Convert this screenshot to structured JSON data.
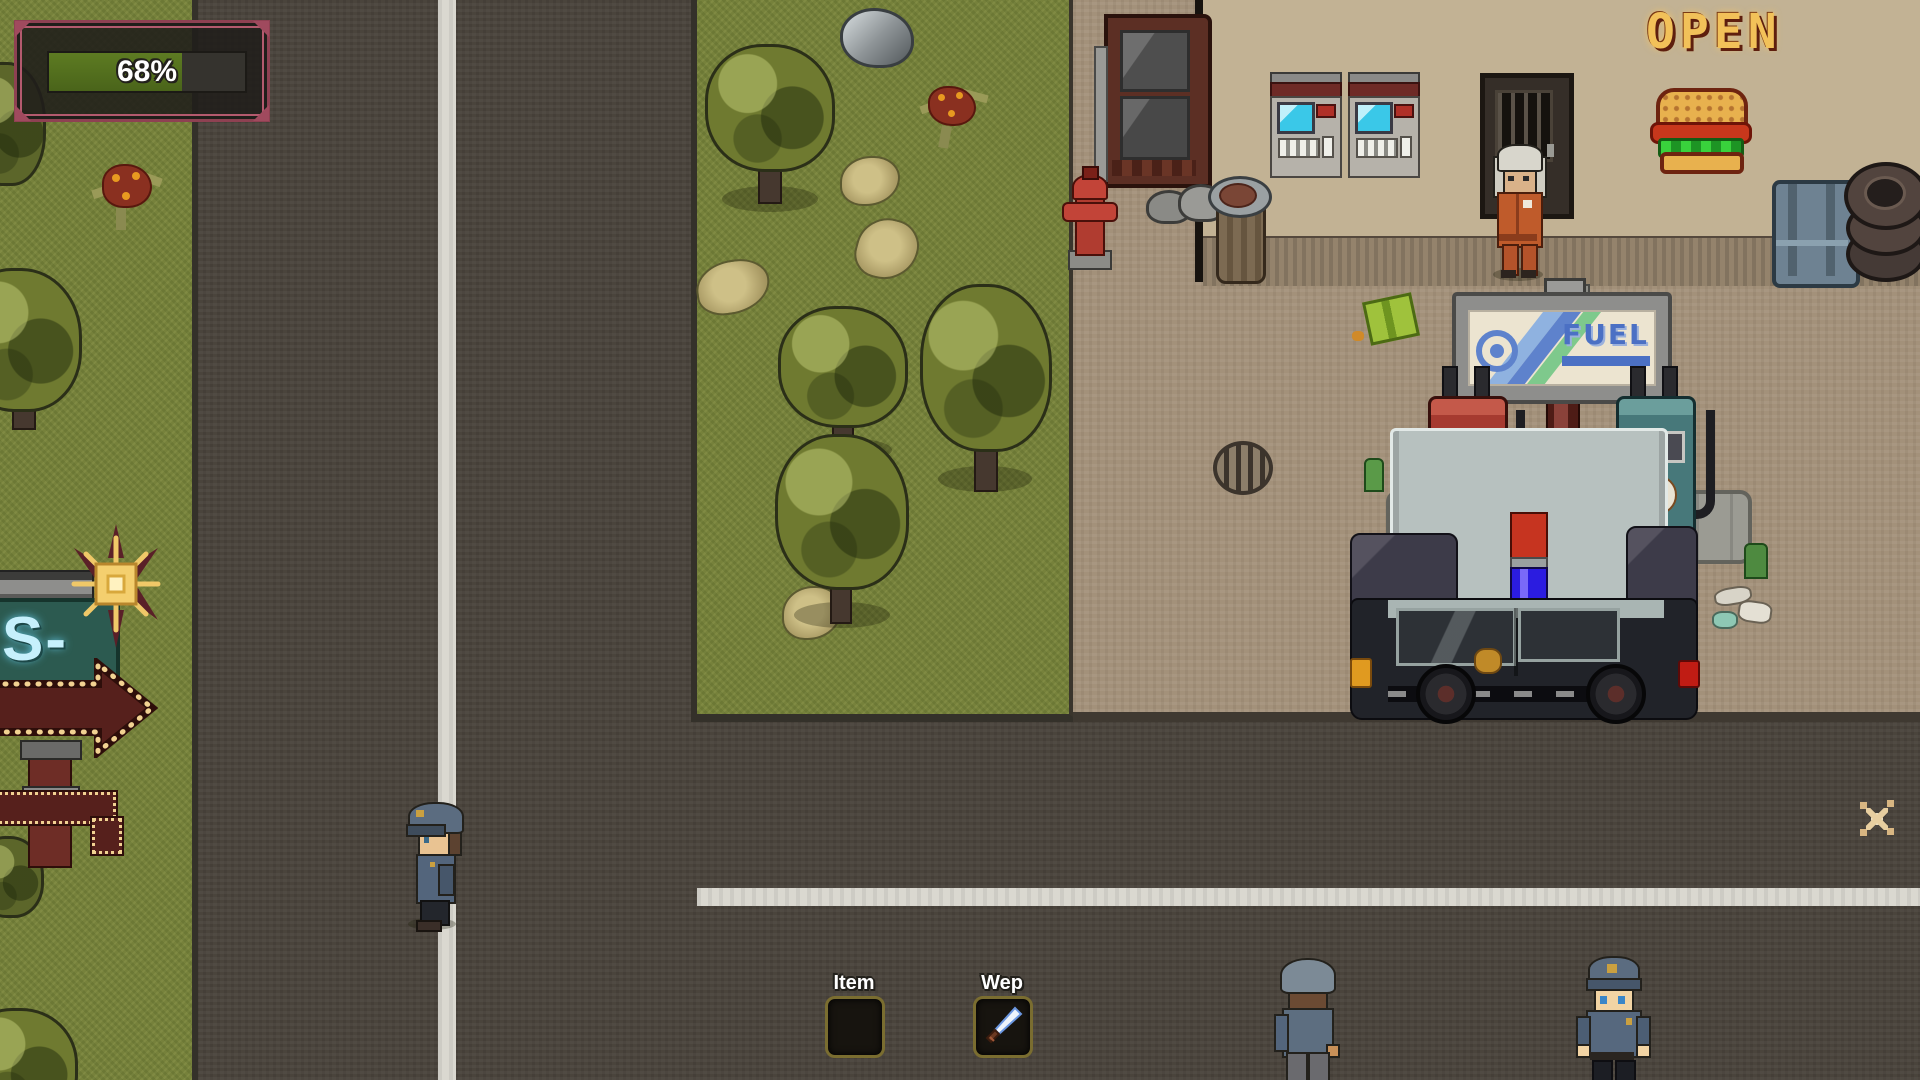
{
  "hud": {
    "health_label": "68%",
    "health_percent": 68
  },
  "hotbar": {
    "slots": [
      {
        "label": "Item",
        "contents": ""
      },
      {
        "label": "Wep",
        "contents": "knife-icon"
      }
    ]
  },
  "gas_station": {
    "open_sign": "OPEN",
    "fuel_sign": "FUEL",
    "burger_sign": "burger-neon-icon"
  },
  "roadside_sign": {
    "text": "S-",
    "direction": "right-arrow"
  },
  "entities": [
    "station-attendant-npc",
    "police-officer-walking",
    "police-officer-back",
    "police-officer-front",
    "police-car",
    "fuel-pump-red",
    "fuel-pump-teal",
    "vending-machine-1",
    "vending-machine-2",
    "green-box-pickup",
    "sparkle-pickup"
  ],
  "colors": {
    "health_fill": "#577020",
    "hud_frame": "#9c4458",
    "slot_border": "#7a6d30",
    "neon_amber": "#f2c159",
    "neon_blue": "#c6f0fc",
    "fuel_blue": "#4b70c4",
    "pump_red": "#a63a30",
    "pump_teal": "#47787a",
    "grass": "#76813b",
    "road": "#4a443c",
    "dirt": "#a3917a",
    "line_white": "#dad8d0"
  }
}
